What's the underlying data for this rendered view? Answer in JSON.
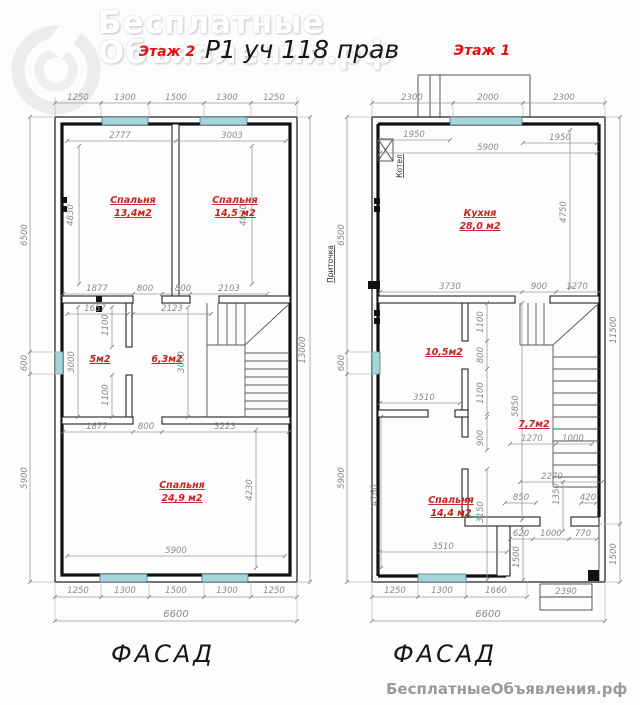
{
  "palette": {
    "room_label": "#c92121",
    "floor_title": "#e01212",
    "window": "#a7d3db",
    "dimension": "#8a8a8a",
    "wall": "#1a1a1a"
  },
  "header": {
    "drawing_title": "Р1 уч 118 прав"
  },
  "watermark": {
    "line1": "Бесплатные",
    "line2": "Объявления.рф"
  },
  "footer": {
    "watermark": "БесплатныеОбъявления.рф"
  },
  "floor2": {
    "title": "Этаж 2",
    "facade_label": "ФАСАД",
    "rooms": {
      "bedroom1": {
        "name": "Спальня",
        "area": "13,4м2"
      },
      "bedroom2": {
        "name": "Спальня",
        "area": "14,5 м2"
      },
      "closet": {
        "area": "5м2"
      },
      "hall": {
        "area": "6,3м2"
      },
      "bedroom3": {
        "name": "Спальня",
        "area": "24,9 м2"
      }
    },
    "dims": {
      "top_row": [
        "1250",
        "1300",
        "1500",
        "1300",
        "1250"
      ],
      "room_widths": [
        "2777",
        "3003"
      ],
      "room_heights": [
        "4830",
        "4830"
      ],
      "left_col": [
        "6500",
        "600",
        "5900"
      ],
      "mid_upper": [
        "1877",
        "800",
        "800",
        "2103"
      ],
      "mid_inner": [
        "1657",
        "2123"
      ],
      "mid_vert": [
        "1100",
        "3000",
        "3000",
        "1100"
      ],
      "mid_lower": [
        "1877",
        "800",
        "3223"
      ],
      "right_col": [
        "13000"
      ],
      "bedroom3_w": "5900",
      "bedroom3_h": "4230",
      "bottom_row": [
        "1250",
        "1300",
        "1500",
        "1300",
        "1250"
      ],
      "total_width": "6600"
    }
  },
  "floor1": {
    "title": "Этаж 1",
    "facade_label": "ФАСАД",
    "equipment": {
      "boiler": "Котел",
      "supply": "Приточка"
    },
    "rooms": {
      "kitchen": {
        "name": "Кухня",
        "area": "28,0 м2"
      },
      "room": {
        "area": "10,5м2"
      },
      "hall": {
        "area": "7,7м2"
      },
      "bedroom": {
        "name": "Спальня",
        "area": "14,4 м2"
      }
    },
    "dims": {
      "top_row": [
        "2300",
        "2000",
        "2300"
      ],
      "top_inner": [
        "1950",
        "5900",
        "1950"
      ],
      "left_col": [
        "6500",
        "600",
        "5900"
      ],
      "kitchen_h": "4750",
      "kitchen_bottom": [
        "3730",
        "900",
        "1270"
      ],
      "partition_vert": [
        "1100",
        "800",
        "1100"
      ],
      "room_w": "3510",
      "hall_h": "5850",
      "right_col": [
        "11500",
        "1500"
      ],
      "hall_row": [
        "1270",
        "1000"
      ],
      "hall_lower": [
        "2270",
        "1350",
        "850",
        "420"
      ],
      "bedroom_vert": [
        "900",
        "3150"
      ],
      "bedroom_w": "3510",
      "bedroom_h": "4160",
      "entry_row": [
        "620",
        "1000",
        "770"
      ],
      "entry_left_depth": "1500",
      "porch_w": "2390",
      "bottom_row": [
        "1250",
        "1300",
        "1660"
      ],
      "total_width": "6600"
    }
  }
}
